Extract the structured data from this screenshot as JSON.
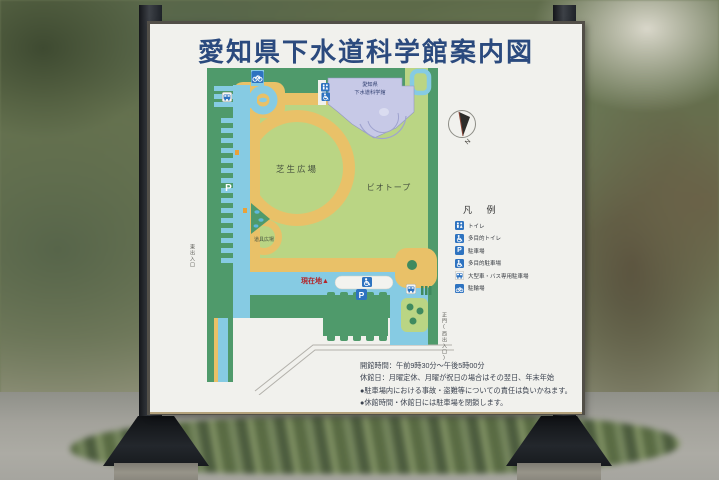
{
  "sign": {
    "title": "愛知県下水道科学館案内図",
    "map": {
      "labels": {
        "lawn_plaza": "芝生広場",
        "biotope": "ビオトープ",
        "tool_plaza": "道具広場",
        "building_line1": "愛知県",
        "building_line2": "下水道科学館",
        "current_location": "現在地▲",
        "east_entrance": "東出入口",
        "west_gate": "正門(西出入口)"
      }
    },
    "legend": {
      "title": "凡 例",
      "items": [
        {
          "icon": "toilet-icon",
          "label": "トイレ"
        },
        {
          "icon": "accessible-toilet-icon",
          "label": "多目的トイレ"
        },
        {
          "icon": "parking-icon",
          "label": "駐車場"
        },
        {
          "icon": "accessible-parking-icon",
          "label": "多目的駐車場"
        },
        {
          "icon": "bus-parking-icon",
          "label": "大型車・バス専用駐車場"
        },
        {
          "icon": "bicycle-parking-icon",
          "label": "駐輪場"
        }
      ]
    },
    "notes": [
      "開館時間：午前9時30分～午後5時00分",
      "休館日：月曜定休、月曜が祝日の場合はその翌日、年末年始",
      "●駐車場内における事故・盗難等についての責任は負いかねます。",
      "●休館時間・休館日には駐車場を閉鎖します。"
    ]
  },
  "glyphs": {
    "parking": "P",
    "north": "N"
  },
  "colors": {
    "title_text": "#2b4a7e",
    "park_green": "#4f9a6b",
    "lawn_green": "#bad584",
    "path_tan": "#e9c168",
    "road_blue": "#86cbe3",
    "building_lavender": "#c7c9e7",
    "icon_blue": "#2e73c0",
    "current_location_red": "#b3262a",
    "sign_white": "#f1f1ed"
  }
}
